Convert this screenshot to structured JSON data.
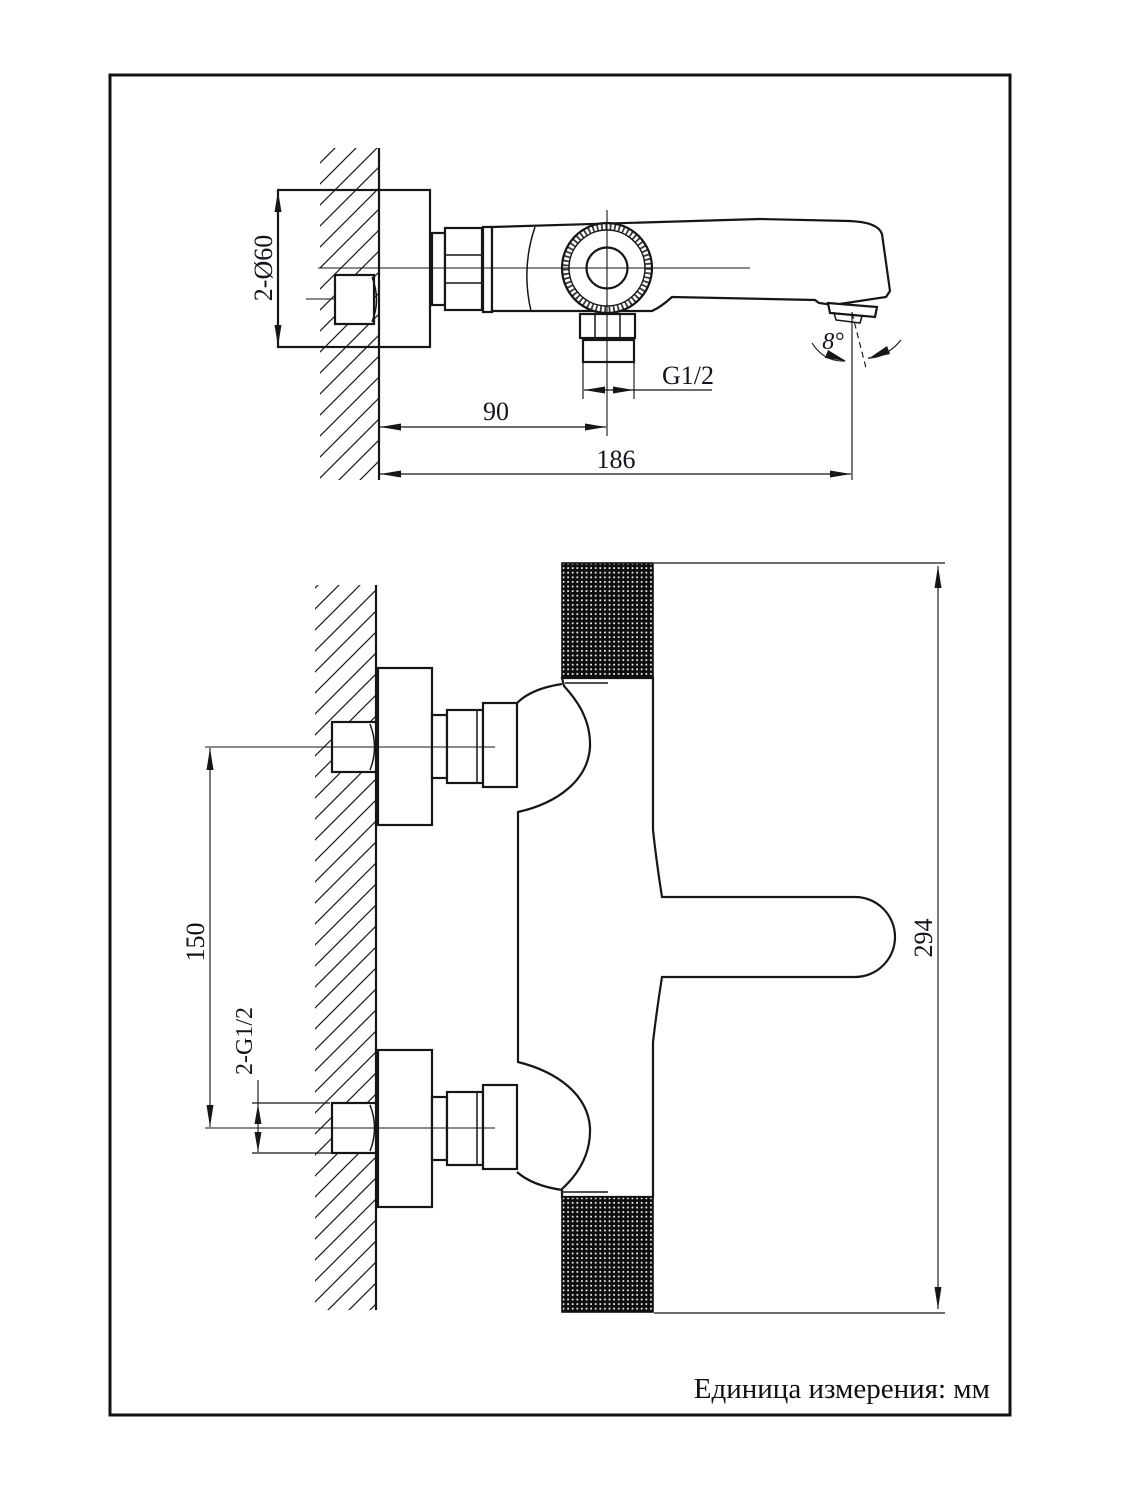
{
  "page": {
    "background": "#ffffff",
    "line_color": "#161616"
  },
  "drawing": {
    "unit_note": "Единица измерения: мм",
    "side_view": {
      "dim_plate_diameter": "2-Ø60",
      "dim_outlet_thread": "G1/2",
      "dim_wall_to_outlet": "90",
      "dim_wall_to_spout_tip": "186",
      "dim_spout_angle": "8°",
      "values": {
        "plate_diameter_mm": 60,
        "wall_to_outlet_mm": 90,
        "wall_to_spout_tip_mm": 186,
        "spout_angle_deg": 8
      }
    },
    "plan_view": {
      "dim_inlet_center_distance": "150",
      "dim_inlet_thread": "2-G1/2",
      "dim_overall_length": "294",
      "values": {
        "inlet_center_distance_mm": 150,
        "overall_length_mm": 294
      }
    }
  }
}
